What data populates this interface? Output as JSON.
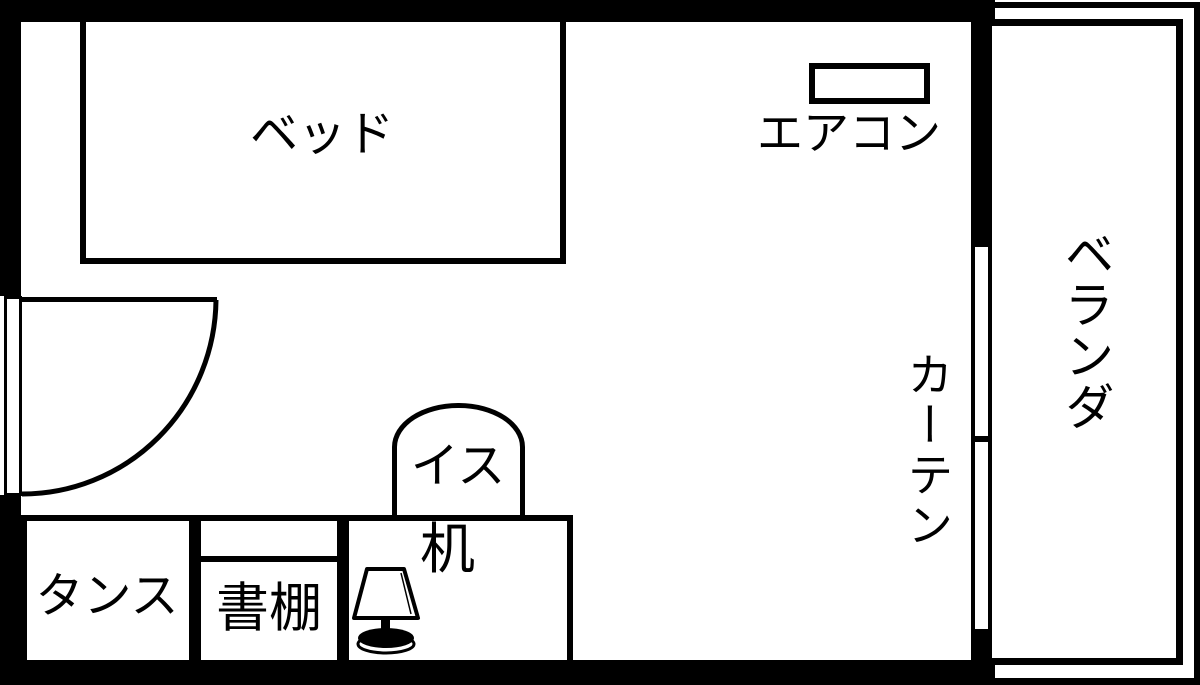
{
  "labels": {
    "bed": "ベッド",
    "aircon": "エアコン",
    "chair": "イス",
    "desk": "机",
    "tansu": "タンス",
    "bookshelf": "書棚",
    "curtain": "カーテン",
    "veranda": "ベランダ"
  },
  "colors": {
    "line": "#000000",
    "background": "#ffffff"
  }
}
